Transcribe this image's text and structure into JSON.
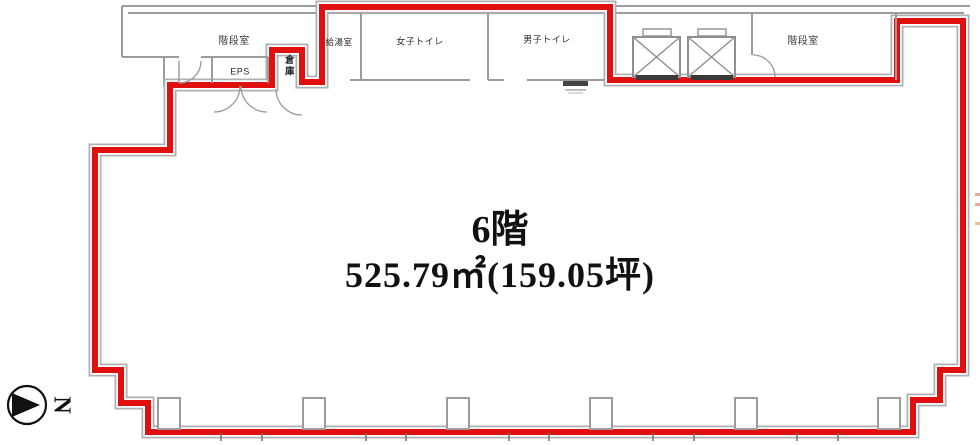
{
  "floor_info": {
    "title": "6階",
    "area": "525.79㎡(159.05坪)"
  },
  "rooms": {
    "stairwell_left": "階段室",
    "eps": "EPS",
    "storage": "倉庫",
    "kitchenette": "給湯室",
    "womens_toilet": "女子トイレ",
    "mens_toilet": "男子トイレ",
    "stairwell_right": "階段室"
  },
  "compass": {
    "north_label": "N"
  },
  "colors": {
    "lease_boundary_red": "#e01010",
    "wall_gray": "#9c9c9c",
    "text_black": "#1c1c1c"
  }
}
